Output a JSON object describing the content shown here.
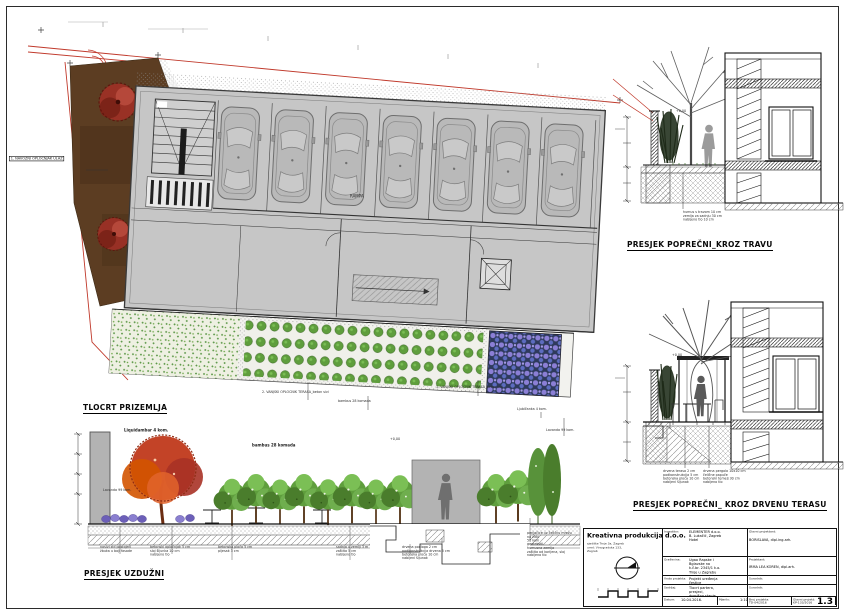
{
  "colors": {
    "boundary_red": "#c0392b",
    "building_gray": "#c6c6c6",
    "soil_brown": "#5c3d22",
    "foliage_green": "#5f9e3d",
    "maple_red": "#c0391b",
    "lavender_purple": "#7b6fd0"
  },
  "headings": {
    "plan": "TLOCRT PRIZEMLJA",
    "long_section": "PRESJEK UZDUŽNI",
    "cross_grass": "PRESJEK POPREČNI_KROZ TRAVU",
    "cross_deck": "PRESJEK POPREČNI_ KROZ DRVENU TERASU"
  },
  "plan": {
    "entry_label": "1. NAVOZNI OPLOČNJAK ULAZ",
    "garage_label": "RAMPA",
    "terrace_note_left": "2. VANJSKI OPLOČNIK TERASA_beton sivi",
    "terrace_note_right": "1. VANJSKI OPLOČNIK TERASA_beton sivi",
    "bamboo_note": "bambus 28 komada",
    "flower_note_1": "Ljubičanka 4 kom.",
    "flower_note_2": "Lavanda 99 kom."
  },
  "long_section": {
    "tree_label": "Liquidambar 4 kom.",
    "lavender_label": "Lavanda 99 kom.",
    "bamboo_label": "bambus 28 komada",
    "level_label": "+0,00",
    "notes": [
      "nosivi zid postojeći\nžbuka u boji fasade",
      "betonski opločnjak 5 cm\nsloj šljunka 10 cm\nnabijeno tlo",
      "betonska ploča 5 cm\npijesak 3 cm",
      "sadnja u zemlji 3 m\nzaštita 5 cm\nnabijeno tlo",
      "drvena podloga 2 cm\npodkonstrukcija drvena 5 cm\nbetonska ploča 10 cm\nnabijeni šljunak",
      "penjačice uz čeličnu mrežu\nna zidu\n50 kom\ngeotekstil\nhumusna zemlja\nzaštita od korijena, sloj\nnabijeno tlo"
    ]
  },
  "cross_grass": {
    "level_label": "+0,00",
    "note": "humus s travom 10 cm\nzemlja za sadnju 30 cm\nnabijeno tlo 10 cm"
  },
  "cross_deck": {
    "level_label": "+0,00",
    "note_left": "drvena terasa 2 cm\npodkonstrukcija 5 cm\nbetonska ploča 10 cm\nnabijeni šljunak",
    "note_right": "drvena pergola 10x10 cm\nčelične papuče\nbetonski temelj 30 cm\nnabijeno tlo"
  },
  "titleblock": {
    "company": "Kreativna produkcija d.o.o.",
    "company_addr": "sjedište Trnje 3a, Zagreb\nured: Vinogradska 133, Zagreb",
    "investitor_label": "Investitor:",
    "investitor_value": "ELEMENTER d.o.o.\nB. Lukačić, Zagreb\nHotel",
    "gradevina_label": "Građevina:",
    "gradevina_value": "Ugao Rapske i Bglavske na\nk.č.br. 2345/1 k.o. Trnje u Zagrebu",
    "vrsta_label": "Vrsta projekta:",
    "vrsta_value": "Projekt uređenja čestice",
    "sadrzaj_label": "Sadržaj:",
    "sadrzaj_value": "Tlocrt partera, presjeci,\ndvorišno stanje",
    "datum_label": "Datum:",
    "datum_value": "10.04.2016.",
    "mjerilo_label": "Mjerilo:",
    "mjerilo_value": "1:100",
    "glavni_label": "Glavni projektant:",
    "glavni_value": "BORISLAVA, dipl.ing.arh.",
    "projektant_label": "Projektant:",
    "projektant_value": "IRMA LEA KOREN, dipl.arh.",
    "suradnik1_label": "Suradnik:",
    "suradnik2_label": "Suradnik:",
    "broj_label": "Broj projekta:",
    "broj_value": "TD-04/2016",
    "oznaka_label": "Glavni projekt:",
    "oznaka_value": "KP-133/2016",
    "list_label": "List br:",
    "list_value": "1.3"
  }
}
